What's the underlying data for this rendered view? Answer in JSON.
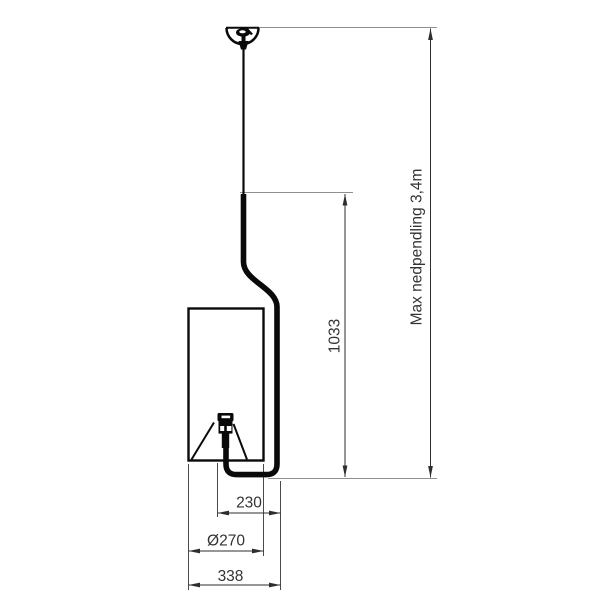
{
  "drawing": {
    "subject": "pendant-lamp-dimension-drawing",
    "dimensions": {
      "max_drop": {
        "label": "Max nedpendling 3,4m"
      },
      "height": {
        "label": "1033"
      },
      "center_offset": {
        "label": "230"
      },
      "shade_diameter": {
        "label": "Ø270"
      },
      "total_width": {
        "label": "338"
      }
    },
    "colors": {
      "background": "#ffffff",
      "product_outline": "#0a0a0a",
      "dimension_line": "#2e2e2e",
      "extension_line": "#4a4a4a",
      "reference_line": "#8f8f8f",
      "text": "#333333"
    }
  }
}
